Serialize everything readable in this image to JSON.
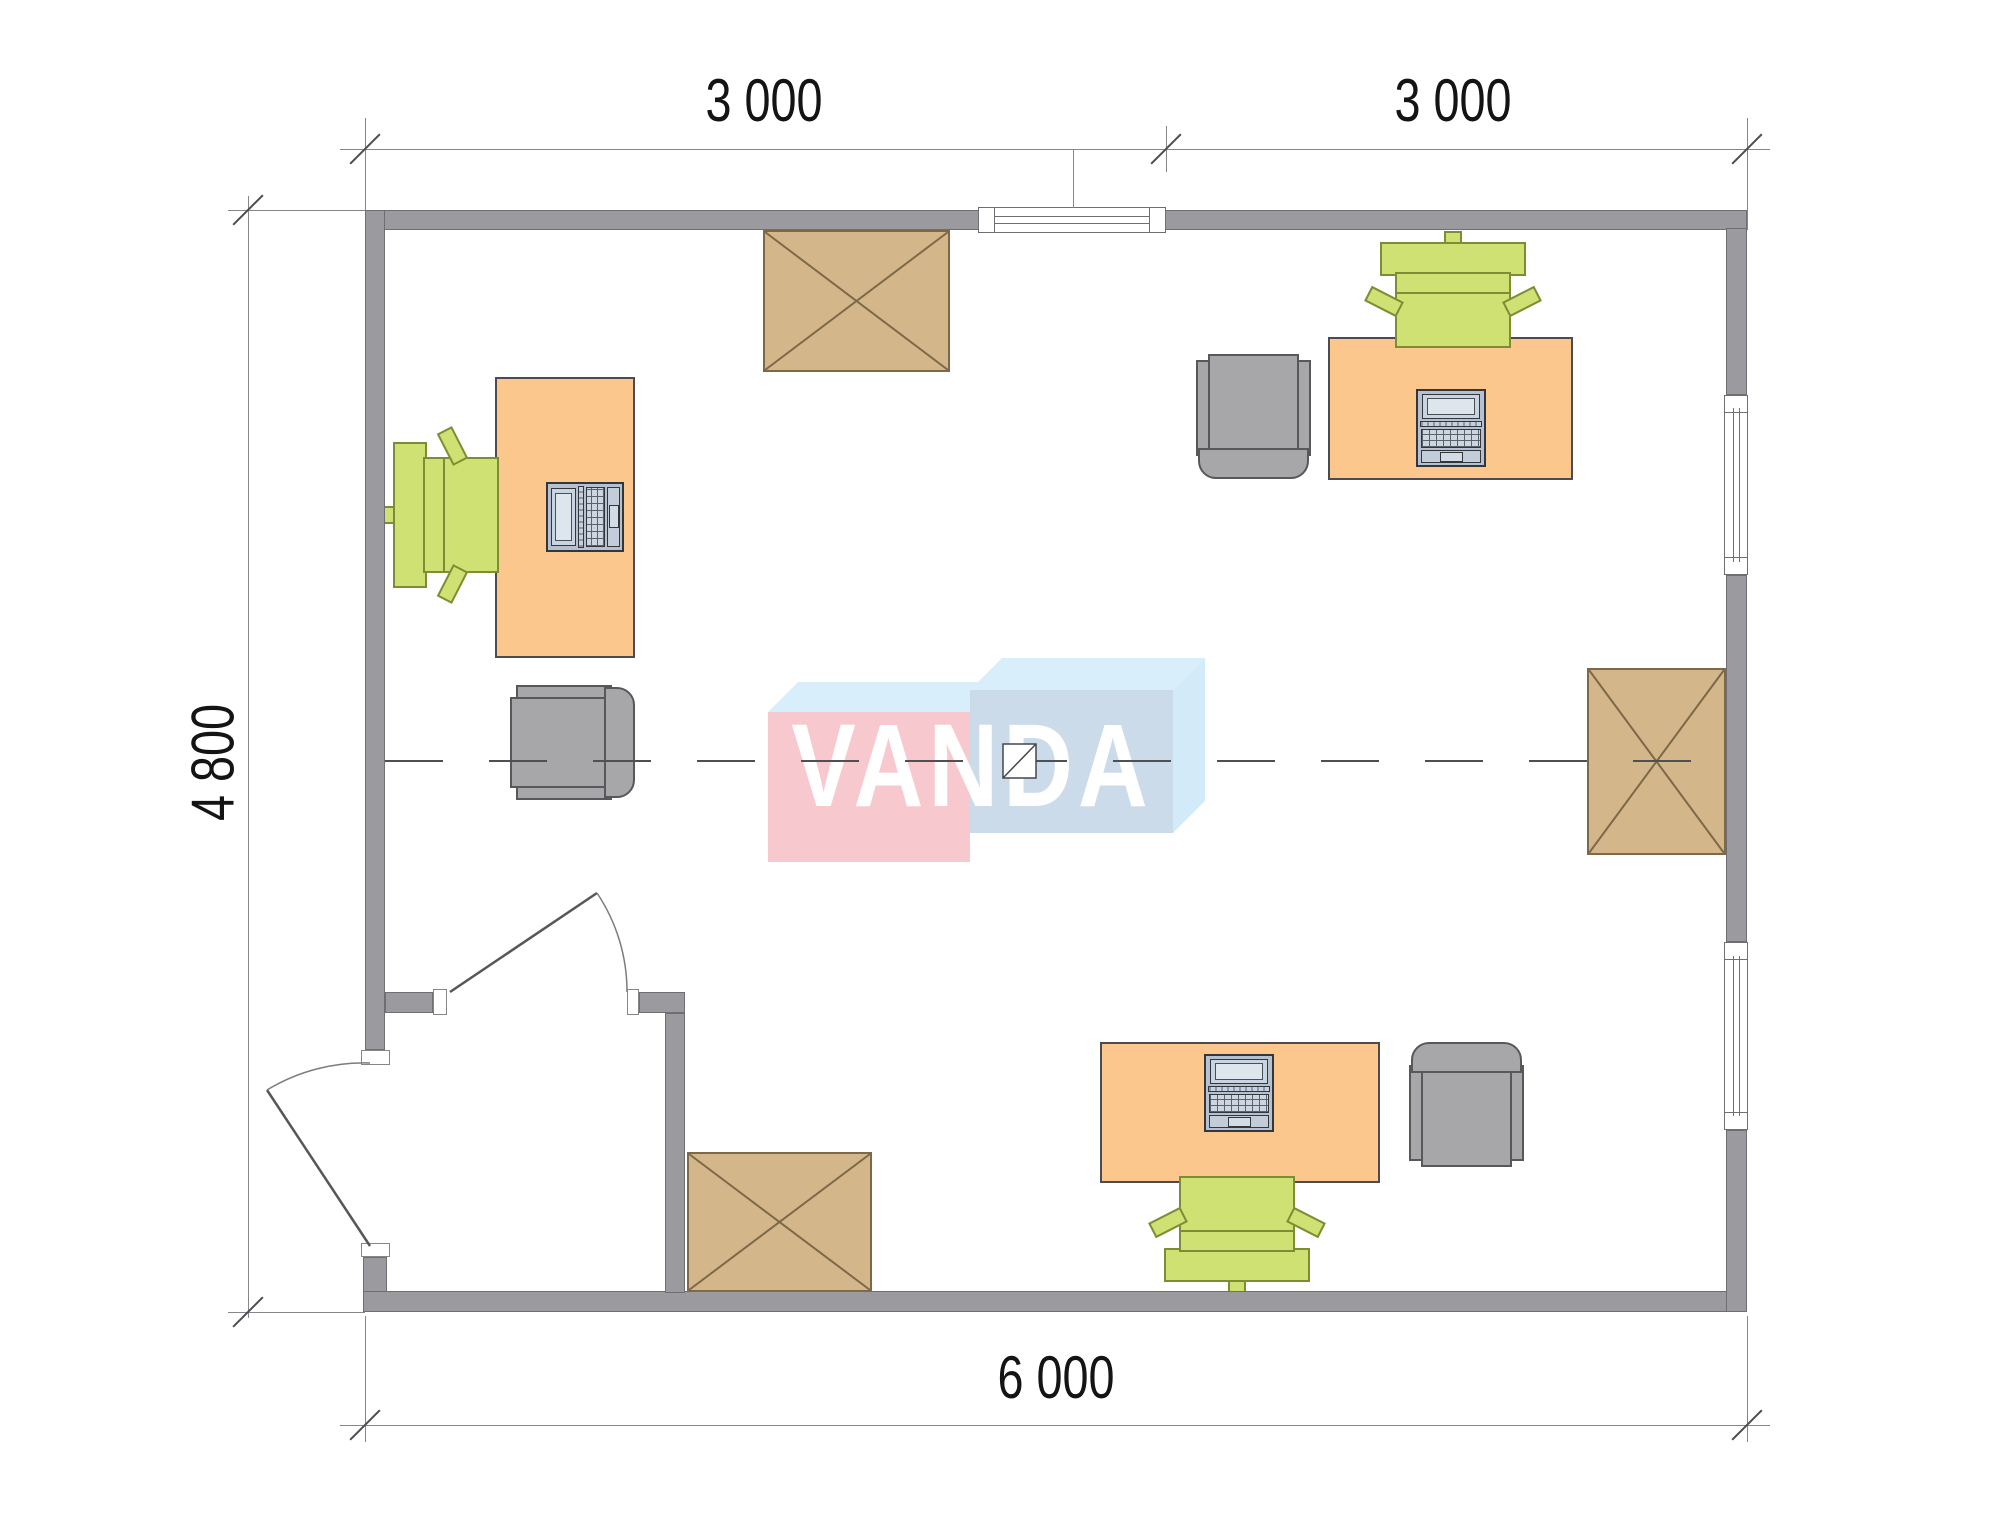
{
  "page": {
    "kind": "architectural-floor-plan",
    "background": "#ffffff"
  },
  "dimensions": {
    "top_segment_1": "3 000",
    "top_segment_2": "3 000",
    "side_height": "4 800",
    "bottom_width": "6 000"
  },
  "watermark": {
    "text": "VANDA",
    "text_color": "#ffffff",
    "box_left_front_color": "#f7c9cf",
    "box_right_front_color": "#cbdbea",
    "box_top_color": "#d9eefb"
  },
  "colors": {
    "wall": "#9b9b9f",
    "desk": "#fcc78d",
    "table": "#d3b78b",
    "table_line": "#7d6848",
    "chair_green": "#cfe173",
    "chair_gray": "#a7a7a9",
    "laptop": "#b5c1d1",
    "centerline": "#4e5054",
    "dimension_line": "#85878a",
    "dimension_text": "#141414"
  },
  "furniture": [
    {
      "type": "desk-with-laptop",
      "location": "left"
    },
    {
      "type": "desk-with-laptop",
      "location": "top-right"
    },
    {
      "type": "desk-with-laptop",
      "location": "bottom"
    },
    {
      "type": "task-chair-green",
      "location": "left"
    },
    {
      "type": "task-chair-green",
      "location": "top-right"
    },
    {
      "type": "task-chair-green",
      "location": "bottom"
    },
    {
      "type": "armchair-gray",
      "location": "left"
    },
    {
      "type": "armchair-gray",
      "location": "top-right"
    },
    {
      "type": "armchair-gray",
      "location": "bottom-right"
    },
    {
      "type": "x-table",
      "location": "top-center"
    },
    {
      "type": "x-table",
      "location": "right"
    },
    {
      "type": "x-table",
      "location": "bottom-left"
    }
  ],
  "openings": [
    {
      "type": "window",
      "location": "top-wall"
    },
    {
      "type": "window",
      "location": "right-wall-upper"
    },
    {
      "type": "window",
      "location": "right-wall-lower"
    },
    {
      "type": "door",
      "location": "entrance-left"
    },
    {
      "type": "door",
      "location": "vestibule-interior"
    }
  ]
}
